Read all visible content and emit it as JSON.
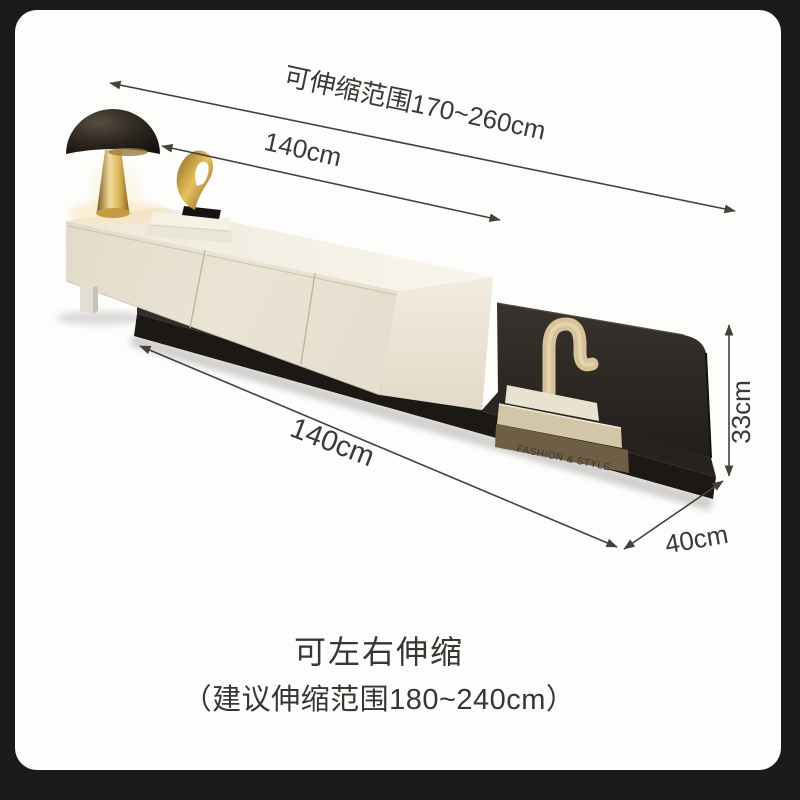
{
  "annotations": {
    "top_range": {
      "label": "可伸缩范围170~260cm"
    },
    "top_width": {
      "label": "140cm"
    },
    "bottom_width": {
      "label": "140cm"
    },
    "depth": {
      "label": "40cm"
    },
    "height": {
      "label": "33cm"
    }
  },
  "captions": {
    "line1": "可左右伸缩",
    "line2": "（建议伸缩范围180~240cm）"
  },
  "decor": {
    "book_spine_text": "FASHION & STYLE"
  },
  "colors": {
    "frame": "#1d1b1a",
    "card": "#fdfdfc",
    "annotation_line": "#45413d",
    "annotation_text": "#3b3835",
    "caption_text": "#383533",
    "cabinet_front": "#e9e3d4",
    "cabinet_top": "#f4f0e5",
    "cabinet_right": "#efe9db",
    "platform_top": "#2e2a26",
    "platform_edge": "#1b1815",
    "back_panel": "#2b2723",
    "lamp_cap": "#1a150f",
    "lamp_stem_gold": "#e3c36a",
    "sculpture_gold": "#c79b3e",
    "book_spine": "#6f5e46",
    "squiggle": "#d7c29a"
  }
}
